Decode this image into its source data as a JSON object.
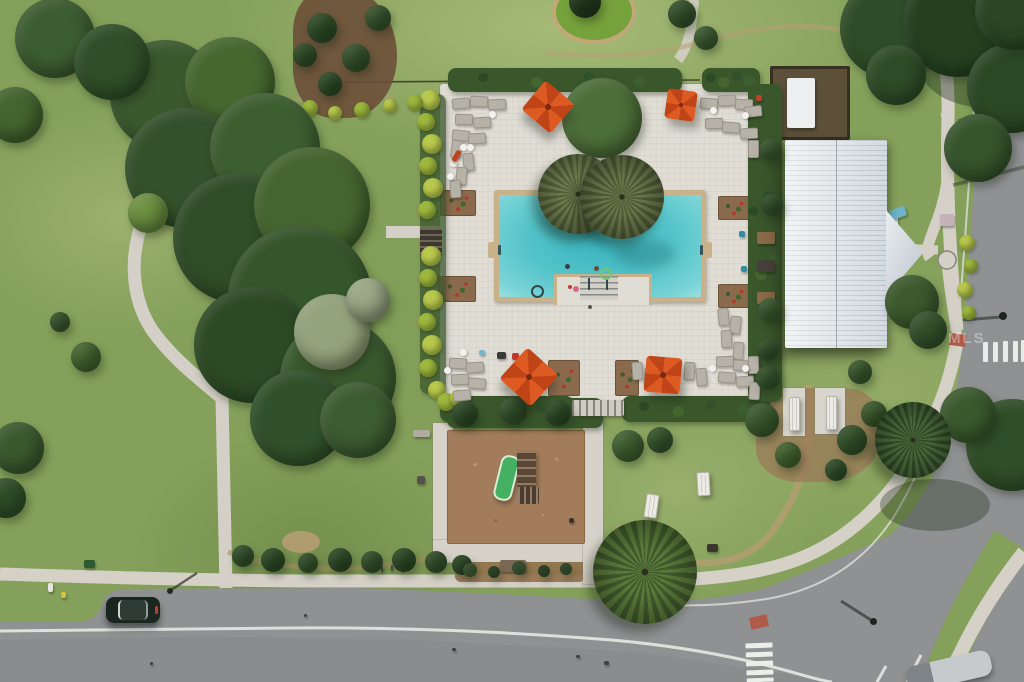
{
  "meta": {
    "description": "Aerial drone photo of a community amenity center with swimming pool, clubhouse, playground and streets",
    "watermark": "MLS"
  },
  "palette": {
    "grass": "#84a05a",
    "road": "#8f9193",
    "sidewalk": "#d5d1c7",
    "deck": "#e0ddd5",
    "coping": "#c9b189",
    "water": "#52c3c9",
    "roof": "#e2e6e9",
    "umbrella": "#de5a23",
    "mulch": "#a37d5b",
    "lime_hedge": "#b9c94e",
    "hedge": "#3a572c"
  },
  "scene": {
    "canvas": {
      "w": 1024,
      "h": 682
    },
    "trees": [
      [
        165,
        95,
        55,
        "#3a5a2e"
      ],
      [
        230,
        82,
        45,
        "#46682f"
      ],
      [
        185,
        168,
        60,
        "#33512a"
      ],
      [
        265,
        148,
        55,
        "#3d5f30"
      ],
      [
        238,
        238,
        65,
        "#2f4d26"
      ],
      [
        312,
        205,
        58,
        "#44652f"
      ],
      [
        300,
        298,
        72,
        "#35552b"
      ],
      [
        252,
        345,
        58,
        "#2c4a24"
      ],
      [
        338,
        378,
        58,
        "#3a5a2e"
      ],
      [
        298,
        418,
        48,
        "#31512a"
      ],
      [
        358,
        420,
        38,
        "#3c5c31"
      ],
      [
        55,
        38,
        40,
        "#3c5c31"
      ],
      [
        112,
        62,
        38,
        "#2f4f28"
      ],
      [
        15,
        115,
        28,
        "#44652f"
      ],
      [
        148,
        213,
        20,
        "#6d9140"
      ],
      [
        18,
        448,
        26,
        "#3a5a2e"
      ],
      [
        6,
        498,
        20,
        "#2f4f28"
      ],
      [
        602,
        118,
        40,
        "#4c6e38"
      ],
      [
        890,
        28,
        50,
        "#2e4c27"
      ],
      [
        958,
        22,
        55,
        "#24401f"
      ],
      [
        1012,
        88,
        45,
        "#2b4825"
      ],
      [
        978,
        148,
        34,
        "#36552c"
      ],
      [
        1015,
        10,
        40,
        "#2a4623"
      ],
      [
        896,
        75,
        30,
        "#2e4c27"
      ],
      [
        1012,
        445,
        46,
        "#2f4f28"
      ],
      [
        968,
        415,
        28,
        "#3a5a2e"
      ],
      [
        628,
        446,
        16,
        "#3f6030"
      ],
      [
        660,
        440,
        13,
        "#35552b"
      ],
      [
        912,
        302,
        27,
        "#3c5a2c"
      ],
      [
        928,
        330,
        19,
        "#33512a"
      ],
      [
        322,
        28,
        15,
        "#2c4a24"
      ],
      [
        356,
        58,
        14,
        "#33512a"
      ],
      [
        330,
        84,
        12,
        "#2c4a24"
      ],
      [
        378,
        18,
        13,
        "#35552b"
      ],
      [
        305,
        55,
        12,
        "#2f4d26"
      ],
      [
        585,
        2,
        16,
        "#22361c"
      ],
      [
        682,
        14,
        14,
        "#33512a"
      ],
      [
        706,
        38,
        12,
        "#3c5c31"
      ],
      [
        762,
        420,
        17,
        "#3a5a2e"
      ],
      [
        788,
        455,
        13,
        "#44652f"
      ],
      [
        852,
        440,
        15,
        "#33512a"
      ],
      [
        874,
        414,
        13,
        "#3c5a2c"
      ],
      [
        836,
        470,
        11,
        "#2f4f28"
      ],
      [
        768,
        378,
        12,
        "#35552b"
      ],
      [
        860,
        372,
        12,
        "#3a5a2e"
      ],
      [
        465,
        414,
        13,
        "#2c4a24"
      ],
      [
        513,
        411,
        14,
        "#33512a"
      ],
      [
        558,
        413,
        13,
        "#2c4a24"
      ],
      [
        243,
        556,
        11,
        "#33512a"
      ],
      [
        273,
        560,
        12,
        "#2c4a24"
      ],
      [
        308,
        563,
        10,
        "#35552b"
      ],
      [
        340,
        560,
        12,
        "#2c4a24"
      ],
      [
        372,
        562,
        11,
        "#33512a"
      ],
      [
        404,
        560,
        12,
        "#2c4a24"
      ],
      [
        436,
        562,
        11,
        "#33512a"
      ],
      [
        462,
        565,
        10,
        "#2c4a24"
      ],
      [
        470,
        570,
        7,
        "#3d5c2f"
      ],
      [
        494,
        572,
        6,
        "#2c4a24"
      ],
      [
        519,
        568,
        7,
        "#3d5c2f"
      ],
      [
        544,
        571,
        6,
        "#2c4a24"
      ],
      [
        566,
        569,
        6,
        "#35552b"
      ],
      [
        86,
        357,
        15,
        "#44652f"
      ],
      [
        60,
        322,
        10,
        "#3a5a2e"
      ],
      [
        332,
        332,
        38,
        "#93a37c"
      ],
      [
        368,
        300,
        22,
        "#9aa886"
      ],
      [
        770,
        150,
        11,
        "#3a5a2e"
      ],
      [
        772,
        205,
        11,
        "#33512a"
      ],
      [
        770,
        310,
        12,
        "#3a5a2e"
      ],
      [
        768,
        350,
        11,
        "#33512a"
      ]
    ],
    "lime_bushes": [
      [
        430,
        100,
        10
      ],
      [
        426,
        122,
        9
      ],
      [
        432,
        144,
        10
      ],
      [
        428,
        166,
        9
      ],
      [
        433,
        188,
        10
      ],
      [
        427,
        210,
        9
      ],
      [
        431,
        256,
        10
      ],
      [
        428,
        278,
        9
      ],
      [
        433,
        300,
        10
      ],
      [
        427,
        322,
        9
      ],
      [
        432,
        345,
        10
      ],
      [
        428,
        368,
        9
      ],
      [
        437,
        390,
        9
      ],
      [
        446,
        402,
        9
      ],
      [
        458,
        398,
        8
      ],
      [
        310,
        108,
        8
      ],
      [
        335,
        113,
        7
      ],
      [
        362,
        110,
        8
      ],
      [
        390,
        106,
        7
      ],
      [
        415,
        103,
        8
      ],
      [
        967,
        243,
        8
      ],
      [
        971,
        266,
        7
      ],
      [
        965,
        290,
        8
      ],
      [
        969,
        313,
        7
      ]
    ],
    "palms": [
      {
        "x": 578,
        "y": 194,
        "r": 40,
        "c1": "#6e7c4e",
        "c2": "#51603a"
      },
      {
        "x": 622,
        "y": 197,
        "r": 42,
        "c1": "#68764a",
        "c2": "#4c5a36"
      },
      {
        "x": 645,
        "y": 572,
        "r": 52,
        "c1": "#5a7a3a",
        "c2": "#41592c"
      },
      {
        "x": 913,
        "y": 440,
        "r": 38,
        "c1": "#48663a",
        "c2": "#304a26"
      }
    ],
    "umbrellas": [
      {
        "x": 529,
        "y": 88,
        "s": 38,
        "rot": 40
      },
      {
        "x": 666,
        "y": 90,
        "s": 30,
        "rot": 8
      },
      {
        "x": 508,
        "y": 356,
        "s": 42,
        "rot": 42
      },
      {
        "x": 645,
        "y": 357,
        "s": 36,
        "rot": 5
      }
    ],
    "loungers": [
      [
        452,
        98,
        16,
        9,
        -5
      ],
      [
        470,
        96,
        16,
        9,
        3
      ],
      [
        488,
        99,
        16,
        9,
        -2
      ],
      [
        455,
        114,
        16,
        9,
        2
      ],
      [
        473,
        117,
        16,
        9,
        -4
      ],
      [
        452,
        130,
        16,
        9,
        6
      ],
      [
        468,
        133,
        16,
        9,
        -3
      ],
      [
        700,
        98,
        16,
        9,
        4
      ],
      [
        718,
        95,
        16,
        9,
        -3
      ],
      [
        735,
        99,
        16,
        9,
        2
      ],
      [
        744,
        106,
        16,
        9,
        -6
      ],
      [
        705,
        118,
        16,
        9,
        -2
      ],
      [
        722,
        122,
        16,
        9,
        5
      ],
      [
        740,
        128,
        16,
        9,
        -3
      ],
      [
        748,
        140,
        9,
        16,
        0
      ],
      [
        451,
        140,
        9,
        16,
        8
      ],
      [
        463,
        153,
        9,
        16,
        -6
      ],
      [
        456,
        167,
        9,
        16,
        5
      ],
      [
        450,
        180,
        9,
        16,
        -4
      ],
      [
        718,
        308,
        9,
        16,
        -5
      ],
      [
        730,
        316,
        9,
        16,
        6
      ],
      [
        721,
        330,
        9,
        16,
        -3
      ],
      [
        733,
        342,
        9,
        16,
        4
      ],
      [
        449,
        358,
        16,
        9,
        3
      ],
      [
        466,
        362,
        16,
        9,
        -4
      ],
      [
        451,
        374,
        16,
        9,
        -2
      ],
      [
        468,
        378,
        16,
        9,
        5
      ],
      [
        453,
        390,
        16,
        9,
        -5
      ],
      [
        632,
        362,
        9,
        16,
        -4
      ],
      [
        644,
        368,
        9,
        16,
        3
      ],
      [
        684,
        362,
        9,
        16,
        4
      ],
      [
        696,
        368,
        9,
        16,
        -5
      ],
      [
        716,
        356,
        16,
        9,
        -3
      ],
      [
        733,
        360,
        16,
        9,
        4
      ],
      [
        748,
        356,
        9,
        16,
        -2
      ],
      [
        718,
        372,
        16,
        9,
        5
      ],
      [
        736,
        376,
        16,
        9,
        -4
      ],
      [
        749,
        382,
        9,
        16,
        3
      ]
    ],
    "round_tables": [
      [
        492,
        114
      ],
      [
        463,
        147
      ],
      [
        713,
        110
      ],
      [
        745,
        115
      ],
      [
        453,
        163
      ],
      [
        450,
        176
      ],
      [
        470,
        147
      ],
      [
        463,
        352
      ],
      [
        447,
        370
      ],
      [
        745,
        368
      ],
      [
        712,
        368
      ]
    ],
    "picnic_tables": [
      [
        645,
        494,
        11,
        22,
        8
      ],
      [
        697,
        472,
        11,
        22,
        -3
      ],
      [
        789,
        397,
        9,
        32,
        0
      ],
      [
        826,
        396,
        9,
        32,
        0
      ]
    ],
    "small_items": [
      [
        454,
        150,
        5,
        12,
        30,
        "#c2401c"
      ],
      [
        512,
        353,
        7,
        7,
        0,
        "#c0392b"
      ],
      [
        497,
        352,
        9,
        7,
        0,
        "#3a3a36"
      ],
      [
        479,
        350,
        6,
        5,
        0,
        "#7ab6c9"
      ],
      [
        739,
        231,
        6,
        6,
        0,
        "#2e8fa0"
      ],
      [
        741,
        266,
        6,
        6,
        0,
        "#2e8fa0"
      ],
      [
        756,
        95,
        6,
        6,
        0,
        "#b8432a"
      ],
      [
        413,
        430,
        17,
        7,
        0,
        "#b0aba0"
      ],
      [
        417,
        476,
        8,
        8,
        0,
        "#55504a"
      ],
      [
        757,
        232,
        18,
        12,
        0,
        "#8a6a48"
      ],
      [
        757,
        260,
        18,
        12,
        0,
        "#46403a"
      ],
      [
        757,
        292,
        18,
        12,
        0,
        "#8a6a48"
      ],
      [
        872,
        216,
        26,
        18,
        0,
        "#d8d5cd"
      ],
      [
        872,
        240,
        26,
        16,
        0,
        "#d8d5cd"
      ],
      [
        890,
        208,
        16,
        10,
        -20,
        "#6fb3c9"
      ],
      [
        940,
        214,
        14,
        12,
        0,
        "#c3b2b8"
      ],
      [
        48,
        583,
        5,
        9,
        0,
        "#e8e6df"
      ],
      [
        61,
        592,
        5,
        6,
        0,
        "#d8c23a"
      ],
      [
        84,
        560,
        11,
        8,
        0,
        "#2e5a33"
      ],
      [
        676,
        543,
        11,
        8,
        0,
        "#3a352f"
      ],
      [
        707,
        544,
        11,
        8,
        0,
        "#3a352f"
      ],
      [
        371,
        565,
        2,
        6,
        0,
        "#4a4a42"
      ],
      [
        381,
        566,
        2,
        6,
        0,
        "#4a4a42"
      ],
      [
        391,
        565,
        2,
        6,
        0,
        "#4a4a42"
      ],
      [
        401,
        566,
        2,
        6,
        0,
        "#4a4a42"
      ],
      [
        500,
        560,
        26,
        12,
        0,
        "#7a6a55"
      ],
      [
        569,
        518,
        5,
        5,
        0,
        "#3c3228"
      ],
      [
        452,
        648,
        4,
        3,
        0,
        "#3f423c"
      ],
      [
        576,
        655,
        4,
        3,
        0,
        "#3f423c"
      ],
      [
        604,
        661,
        5,
        4,
        0,
        "#3f423c"
      ],
      [
        304,
        614,
        3,
        3,
        0,
        "#3f423c"
      ],
      [
        150,
        662,
        3,
        3,
        0,
        "#3f423c"
      ]
    ],
    "people_and_floats": [
      [
        567,
        266,
        2.5,
        "#3a3f42",
        0
      ],
      [
        596,
        268,
        2.5,
        "#6b4a3e",
        0
      ],
      [
        604,
        272,
        4,
        "#7ac46a",
        1
      ],
      [
        535,
        289,
        4.5,
        "#32474a",
        1
      ],
      [
        576,
        289,
        3,
        "#d46a85",
        0
      ],
      [
        570,
        287,
        2,
        "#c43b2a",
        0
      ],
      [
        590,
        307,
        2,
        "#555550",
        0
      ]
    ],
    "lamp_heads": [
      [
        873,
        621,
        3.5,
        "#1e2420",
        0
      ],
      [
        1003,
        316,
        4,
        "#1e2420",
        0
      ],
      [
        170,
        591,
        3,
        "#23281f",
        0
      ]
    ]
  }
}
